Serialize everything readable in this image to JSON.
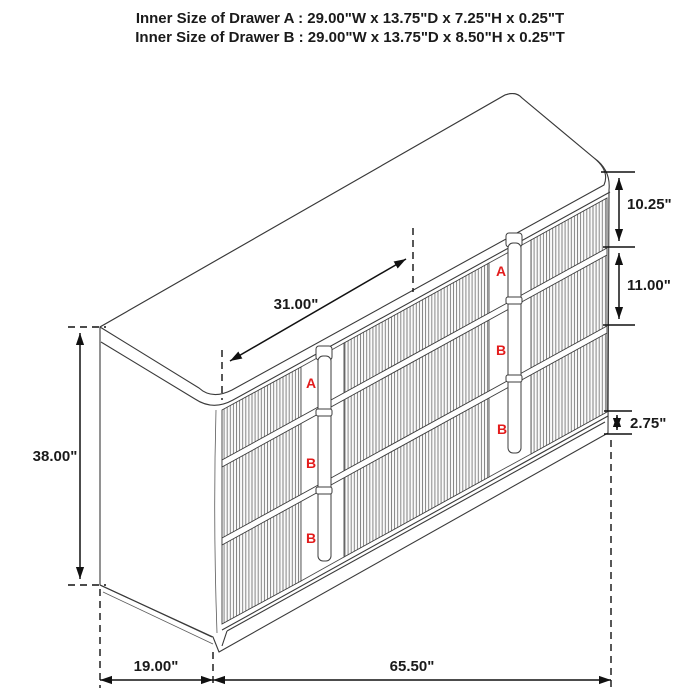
{
  "title": {
    "line1": "Inner Size of Drawer A : 29.00\"W x 13.75\"D x 7.25\"H x 0.25\"T",
    "line2": "Inner Size of Drawer B : 29.00\"W x 13.75\"D x 8.50\"H x 0.25\"T"
  },
  "dimensions": {
    "top_width": "31.00\"",
    "overall_height": "38.00\"",
    "drawer_a_front_height": "10.25\"",
    "drawer_b_front_height": "11.00\"",
    "base_height": "2.75\"",
    "depth": "19.00\"",
    "overall_width": "65.50\""
  },
  "drawer_labels": {
    "column_center": [
      "A",
      "B",
      "B"
    ],
    "column_right": [
      "A",
      "B",
      "B"
    ]
  },
  "colors": {
    "drawer_label_red": "#e31c1c",
    "line_black": "#1a1a1a"
  }
}
